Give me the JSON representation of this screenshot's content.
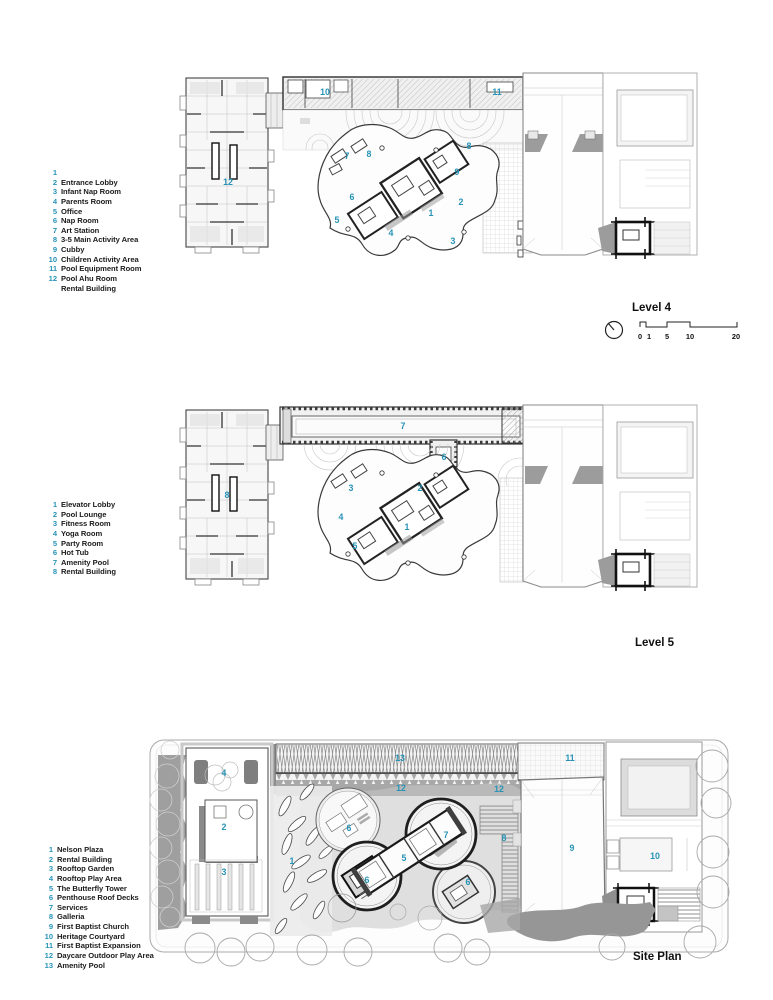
{
  "accent_color": "#2693b6",
  "sections": [
    {
      "id": "level4",
      "title": "Level 4",
      "legend": [
        {
          "n": "1",
          "label": ""
        },
        {
          "n": "2",
          "label": "Entrance Lobby"
        },
        {
          "n": "3",
          "label": "Infant Nap Room"
        },
        {
          "n": "4",
          "label": "Parents Room"
        },
        {
          "n": "5",
          "label": "Office"
        },
        {
          "n": "6",
          "label": "Nap Room"
        },
        {
          "n": "7",
          "label": "Art Station"
        },
        {
          "n": "8",
          "label": "3-5 Main Activity Area"
        },
        {
          "n": "9",
          "label": "Cubby"
        },
        {
          "n": "10",
          "label": "Children Activity Area"
        },
        {
          "n": "11",
          "label": "Pool Equipment Room"
        },
        {
          "n": "12",
          "label": "Pool Ahu Room"
        },
        {
          "n": "",
          "label": "Rental Building"
        }
      ],
      "plan_labels": [
        {
          "n": "10",
          "x": 325,
          "y": 92
        },
        {
          "n": "11",
          "x": 497,
          "y": 92
        },
        {
          "n": "12",
          "x": 228,
          "y": 182
        },
        {
          "n": "7",
          "x": 347,
          "y": 156
        },
        {
          "n": "8",
          "x": 369,
          "y": 154
        },
        {
          "n": "8",
          "x": 469,
          "y": 146
        },
        {
          "n": "9",
          "x": 457,
          "y": 172
        },
        {
          "n": "6",
          "x": 352,
          "y": 197
        },
        {
          "n": "5",
          "x": 337,
          "y": 220
        },
        {
          "n": "4",
          "x": 391,
          "y": 233
        },
        {
          "n": "1",
          "x": 431,
          "y": 213
        },
        {
          "n": "2",
          "x": 461,
          "y": 202
        },
        {
          "n": "3",
          "x": 453,
          "y": 241
        }
      ]
    },
    {
      "id": "level5",
      "title": "Level 5",
      "legend": [
        {
          "n": "1",
          "label": "Elevator Lobby"
        },
        {
          "n": "2",
          "label": "Pool Lounge"
        },
        {
          "n": "3",
          "label": "Fitness Room"
        },
        {
          "n": "4",
          "label": "Yoga Room"
        },
        {
          "n": "5",
          "label": "Party Room"
        },
        {
          "n": "6",
          "label": "Hot Tub"
        },
        {
          "n": "7",
          "label": "Amenity Pool"
        },
        {
          "n": "8",
          "label": "Rental Building"
        }
      ],
      "plan_labels": [
        {
          "n": "7",
          "x": 403,
          "y": 426
        },
        {
          "n": "6",
          "x": 444,
          "y": 457
        },
        {
          "n": "8",
          "x": 227,
          "y": 495
        },
        {
          "n": "3",
          "x": 351,
          "y": 488
        },
        {
          "n": "2",
          "x": 420,
          "y": 488
        },
        {
          "n": "4",
          "x": 341,
          "y": 517
        },
        {
          "n": "1",
          "x": 407,
          "y": 527
        },
        {
          "n": "5",
          "x": 355,
          "y": 546
        }
      ]
    },
    {
      "id": "site",
      "title": "Site Plan",
      "legend": [
        {
          "n": "1",
          "label": "Nelson Plaza"
        },
        {
          "n": "2",
          "label": "Rental Building"
        },
        {
          "n": "3",
          "label": "Rooftop Garden"
        },
        {
          "n": "4",
          "label": "Rooftop Play Area"
        },
        {
          "n": "5",
          "label": "The Butterfly Tower"
        },
        {
          "n": "6",
          "label": "Penthouse Roof Decks"
        },
        {
          "n": "7",
          "label": "Services"
        },
        {
          "n": "8",
          "label": "Galleria"
        },
        {
          "n": "9",
          "label": "First Baptist Church"
        },
        {
          "n": "10",
          "label": "Heritage Courtyard"
        },
        {
          "n": "11",
          "label": "First Baptist Expansion"
        },
        {
          "n": "12",
          "label": "Daycare Outdoor Play Area"
        },
        {
          "n": "13",
          "label": "Amenity Pool"
        }
      ],
      "plan_labels": [
        {
          "n": "13",
          "x": 400,
          "y": 758
        },
        {
          "n": "12",
          "x": 401,
          "y": 788
        },
        {
          "n": "12",
          "x": 499,
          "y": 789
        },
        {
          "n": "4",
          "x": 224,
          "y": 773
        },
        {
          "n": "2",
          "x": 224,
          "y": 827
        },
        {
          "n": "3",
          "x": 224,
          "y": 872
        },
        {
          "n": "1",
          "x": 292,
          "y": 861
        },
        {
          "n": "6",
          "x": 349,
          "y": 828
        },
        {
          "n": "6",
          "x": 367,
          "y": 880
        },
        {
          "n": "6",
          "x": 468,
          "y": 882
        },
        {
          "n": "5",
          "x": 404,
          "y": 858
        },
        {
          "n": "7",
          "x": 446,
          "y": 835
        },
        {
          "n": "8",
          "x": 504,
          "y": 838
        },
        {
          "n": "11",
          "x": 570,
          "y": 758
        },
        {
          "n": "9",
          "x": 572,
          "y": 848
        },
        {
          "n": "10",
          "x": 655,
          "y": 856
        }
      ]
    }
  ],
  "scale_bar": {
    "tick_labels": [
      "0",
      "1",
      "5",
      "10",
      "20"
    ]
  },
  "icons": {
    "north_arrow": "north-arrow"
  }
}
